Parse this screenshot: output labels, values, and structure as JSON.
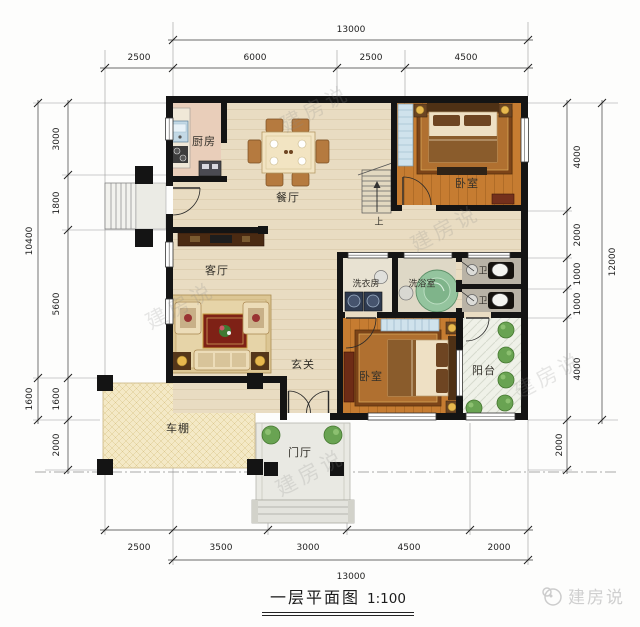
{
  "title": {
    "name": "一层平面图",
    "scale": "1:100"
  },
  "brand": "建房说",
  "watermark": "建房说",
  "rooms": {
    "kitchen": "厨房",
    "dining": "餐厅",
    "living": "客厅",
    "foyer": "玄关",
    "bedroom_top": "卧室",
    "bedroom_bottom": "卧室",
    "laundry": "洗衣房",
    "bath": "洗浴室",
    "wc_top": "卫",
    "wc_bottom": "卫",
    "balcony": "阳台",
    "carport": "车棚",
    "porch": "门厅",
    "stair_up": "上"
  },
  "dimensions": {
    "top": {
      "total": "13000",
      "segments": [
        "2500",
        "6000",
        "2500",
        "4500"
      ]
    },
    "bottom": {
      "total": "13000",
      "segments": [
        "2500",
        "3500",
        "3000",
        "4500",
        "2000"
      ]
    },
    "left": {
      "outer": [
        "10400",
        "1600"
      ],
      "inner": [
        "3000",
        "1800",
        "5600",
        "1600",
        "2000"
      ]
    },
    "right": {
      "outer": [
        "12000"
      ],
      "inner": [
        "4000",
        "2000",
        "1000",
        "1000",
        "4000"
      ],
      "below": [
        "2000"
      ]
    }
  }
}
